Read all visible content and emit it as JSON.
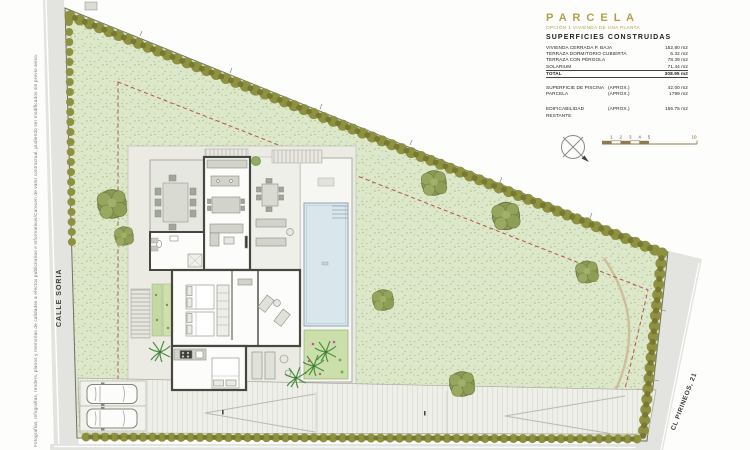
{
  "surfaces": {
    "title": "P A R C E L A",
    "subtitle": "OPCIÓN 1 VIVIENDA DE UNA PLANTA",
    "heading": "SUPERFICIES CONSTRUIDAS",
    "rows": [
      {
        "label": "VIVIENDA CERRADA P. BAJA",
        "value": "152.80 m2"
      },
      {
        "label": "TERRAZA DORMITORIO CUBIERTA",
        "value": "6.32 m2"
      },
      {
        "label": "TERRAZA CON PÉRGOLA",
        "value": "78.39 m2"
      },
      {
        "label": "SOLARIUM",
        "value": "71.44 m2"
      },
      {
        "label": "TOTAL",
        "value": "308.95 m2"
      }
    ],
    "approx": [
      {
        "label": "SUPERFICIE DE PISCINA",
        "note": "(APROX.)",
        "value": "42.00 m2"
      },
      {
        "label": "PARCELA",
        "note": "(APROX.)",
        "value": "1799 m2"
      }
    ],
    "remaining": {
      "label": "EDIFICABILIDAD RESTANTE",
      "note": "(APROX.)",
      "value": "156.75 m2"
    }
  },
  "streets": {
    "left": "CALLE SORIA",
    "right": "CL PIRINEOS, 21"
  },
  "disclaimer": "Fotografías, infografías, renders, planos y memorias de calidades a efectos publicitarios e informativos/Carecen de valor contractual, pudiendo ser modificados sin previo aviso.",
  "scale_bar": {
    "ticks": [
      "1",
      "2",
      "3",
      "4",
      "5"
    ],
    "end": "10"
  },
  "colors": {
    "accent_gold": "#b0a04b",
    "grass": "#dde7ca",
    "hedge": "#8e9140",
    "pool_water": "#d9e6ec",
    "setback_dashed": "#b5544e",
    "street_gray": "#e3e3e0"
  }
}
